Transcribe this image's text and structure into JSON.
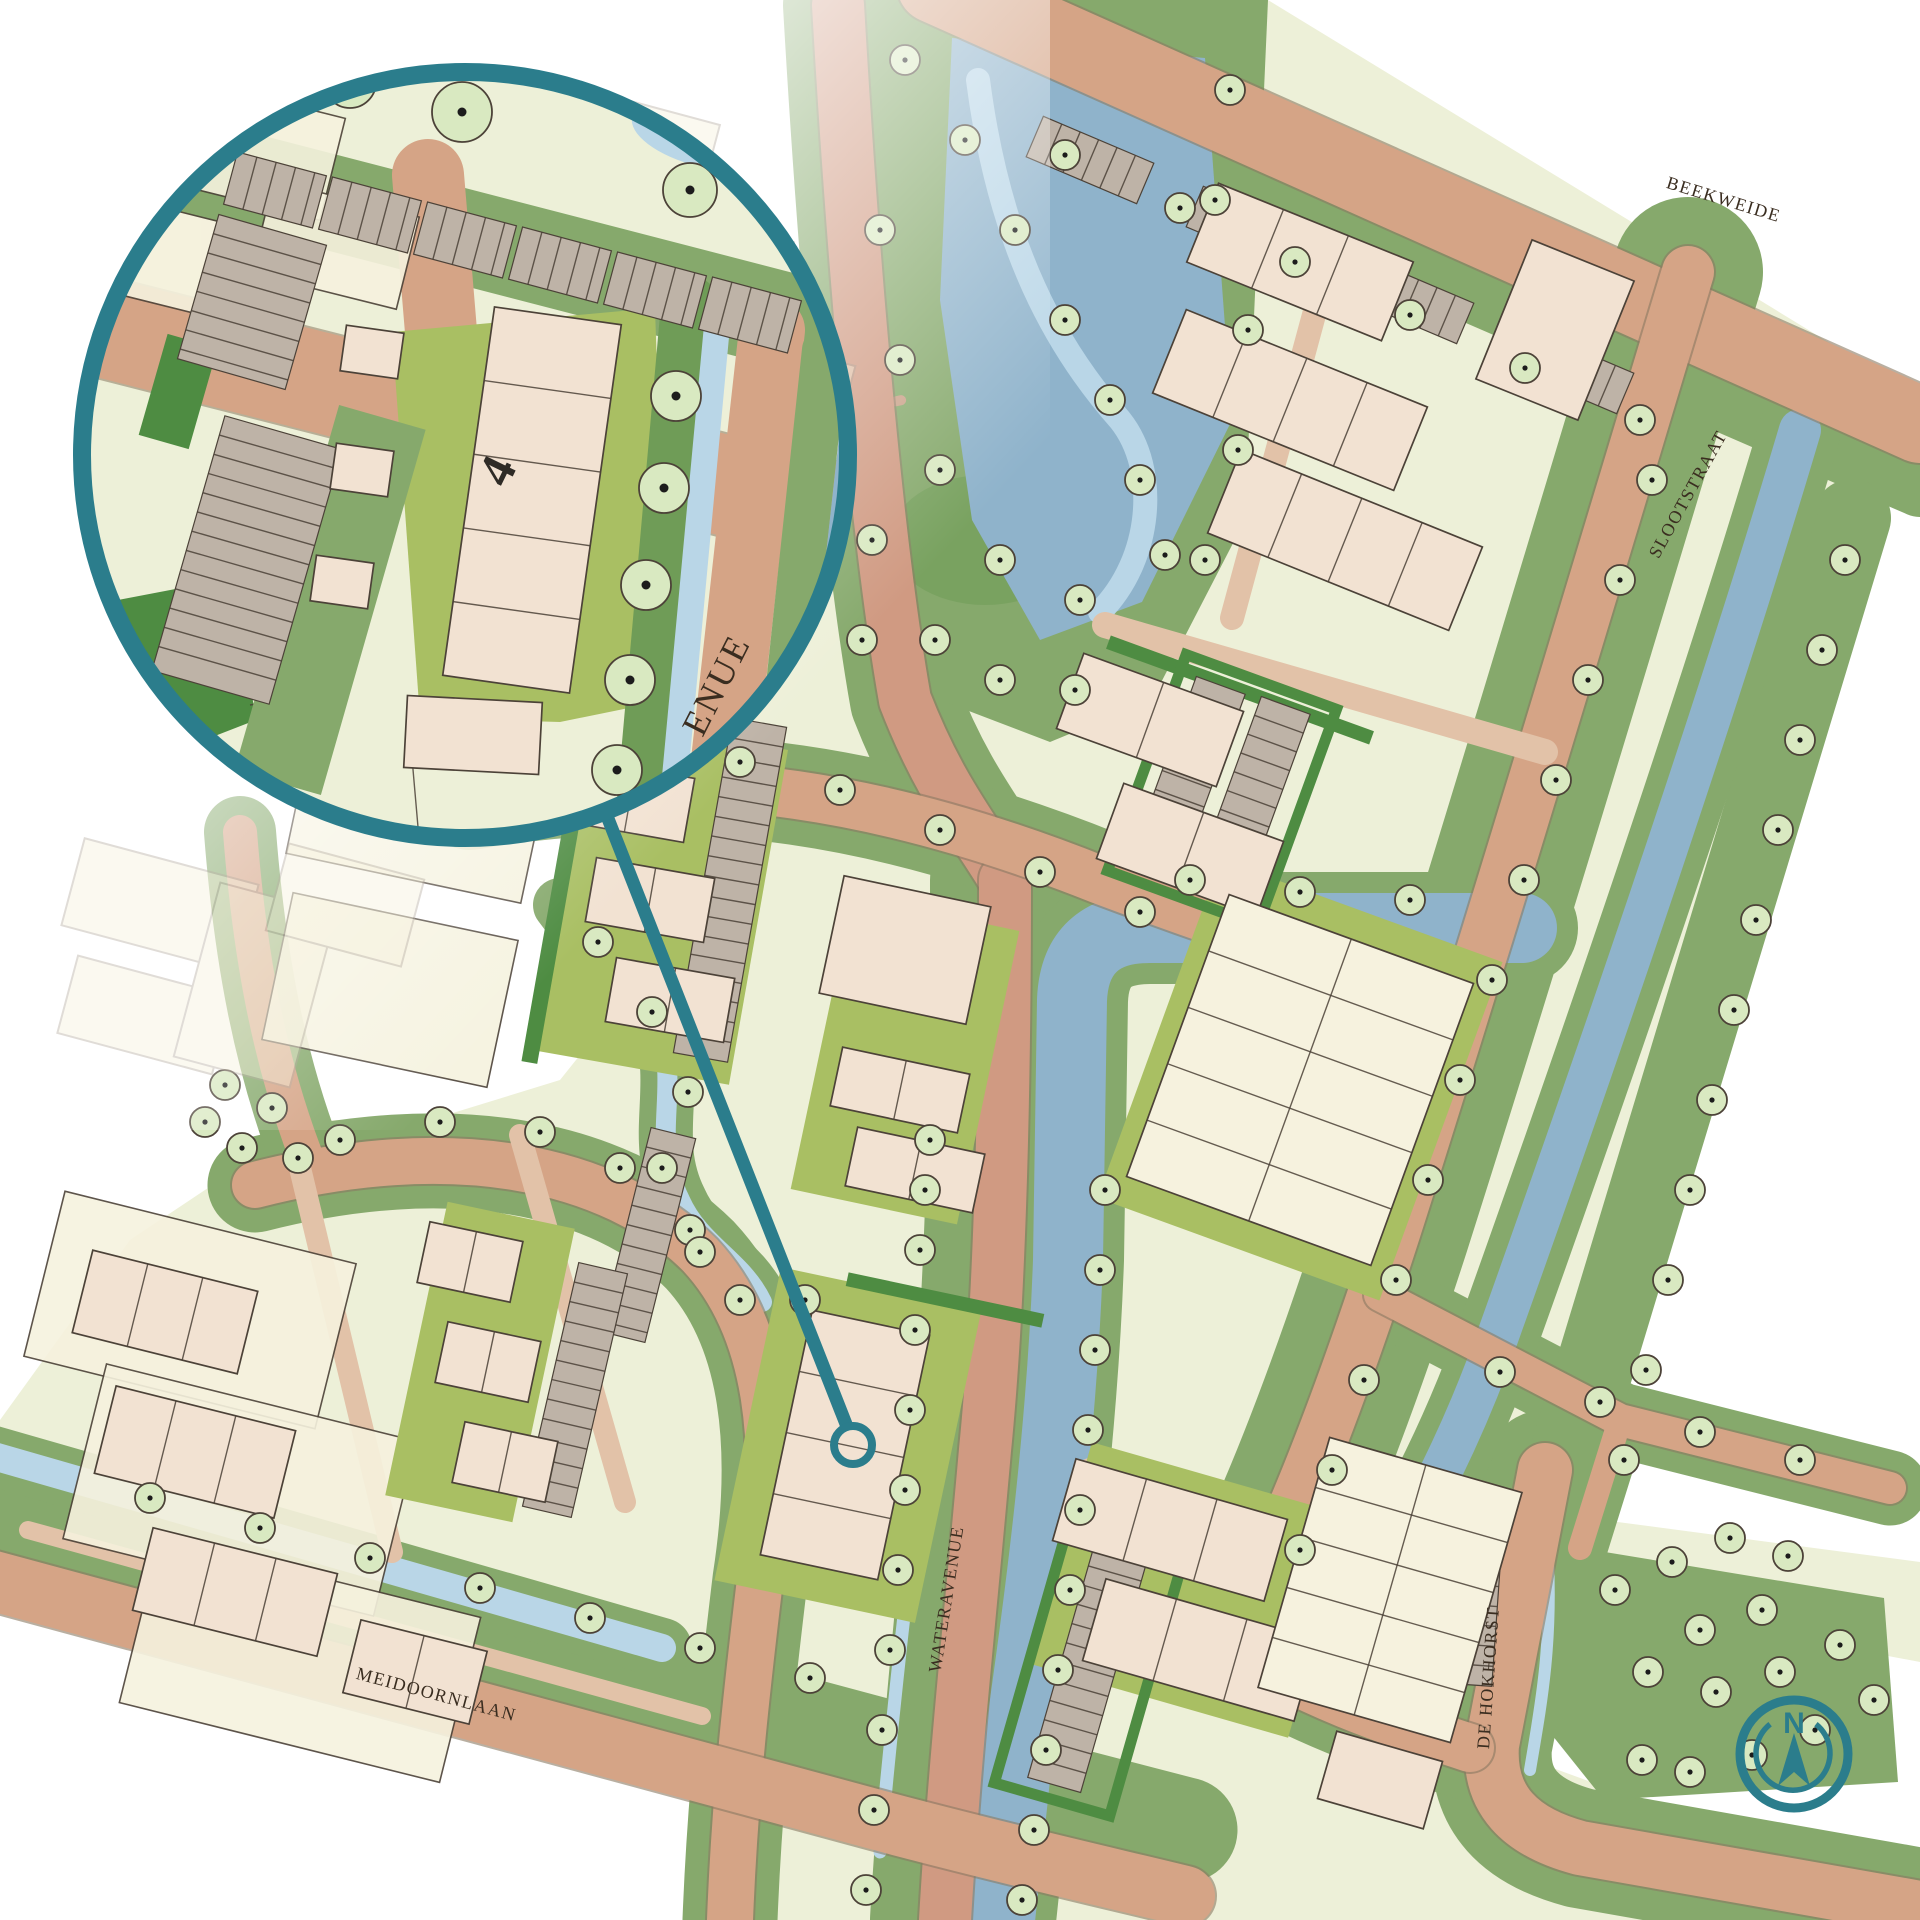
{
  "map": {
    "street_labels": [
      {
        "id": "beekweide",
        "label": "BEEKWEIDE"
      },
      {
        "id": "slootstraat",
        "label": "SLOOTSTRAAT"
      },
      {
        "id": "wateravenue",
        "label": "WATERAVENUE"
      },
      {
        "id": "meidoornlaan",
        "label": "MEIDOORNLAAN"
      },
      {
        "id": "de-hokhorst",
        "label": "DE HOKHORST"
      }
    ],
    "inset": {
      "plot_number": "4",
      "street_label_visible": "ENUE"
    },
    "compass": {
      "north_label": "N"
    },
    "colors": {
      "teal": "#2b7d8c",
      "road": "#d5a486",
      "road_light": "#e2c2a8",
      "road_salmon": "#d09a82",
      "casing": "#8a7a62",
      "grass": "#86a96c",
      "grass_dark": "#6f9c57",
      "hedge": "#4e8c42",
      "garden": "#a9bf63",
      "block": "#edf0d8",
      "cream": "#f6f2de",
      "building": "#f2e2d2",
      "parking": "#beb3a7",
      "water": "#8fb3cb",
      "water_light": "#b9d6e7",
      "tree": "#d9e9c1",
      "outline": "#4c4238",
      "ghost": "#b9b1a5",
      "label": "#3a2d20"
    }
  }
}
